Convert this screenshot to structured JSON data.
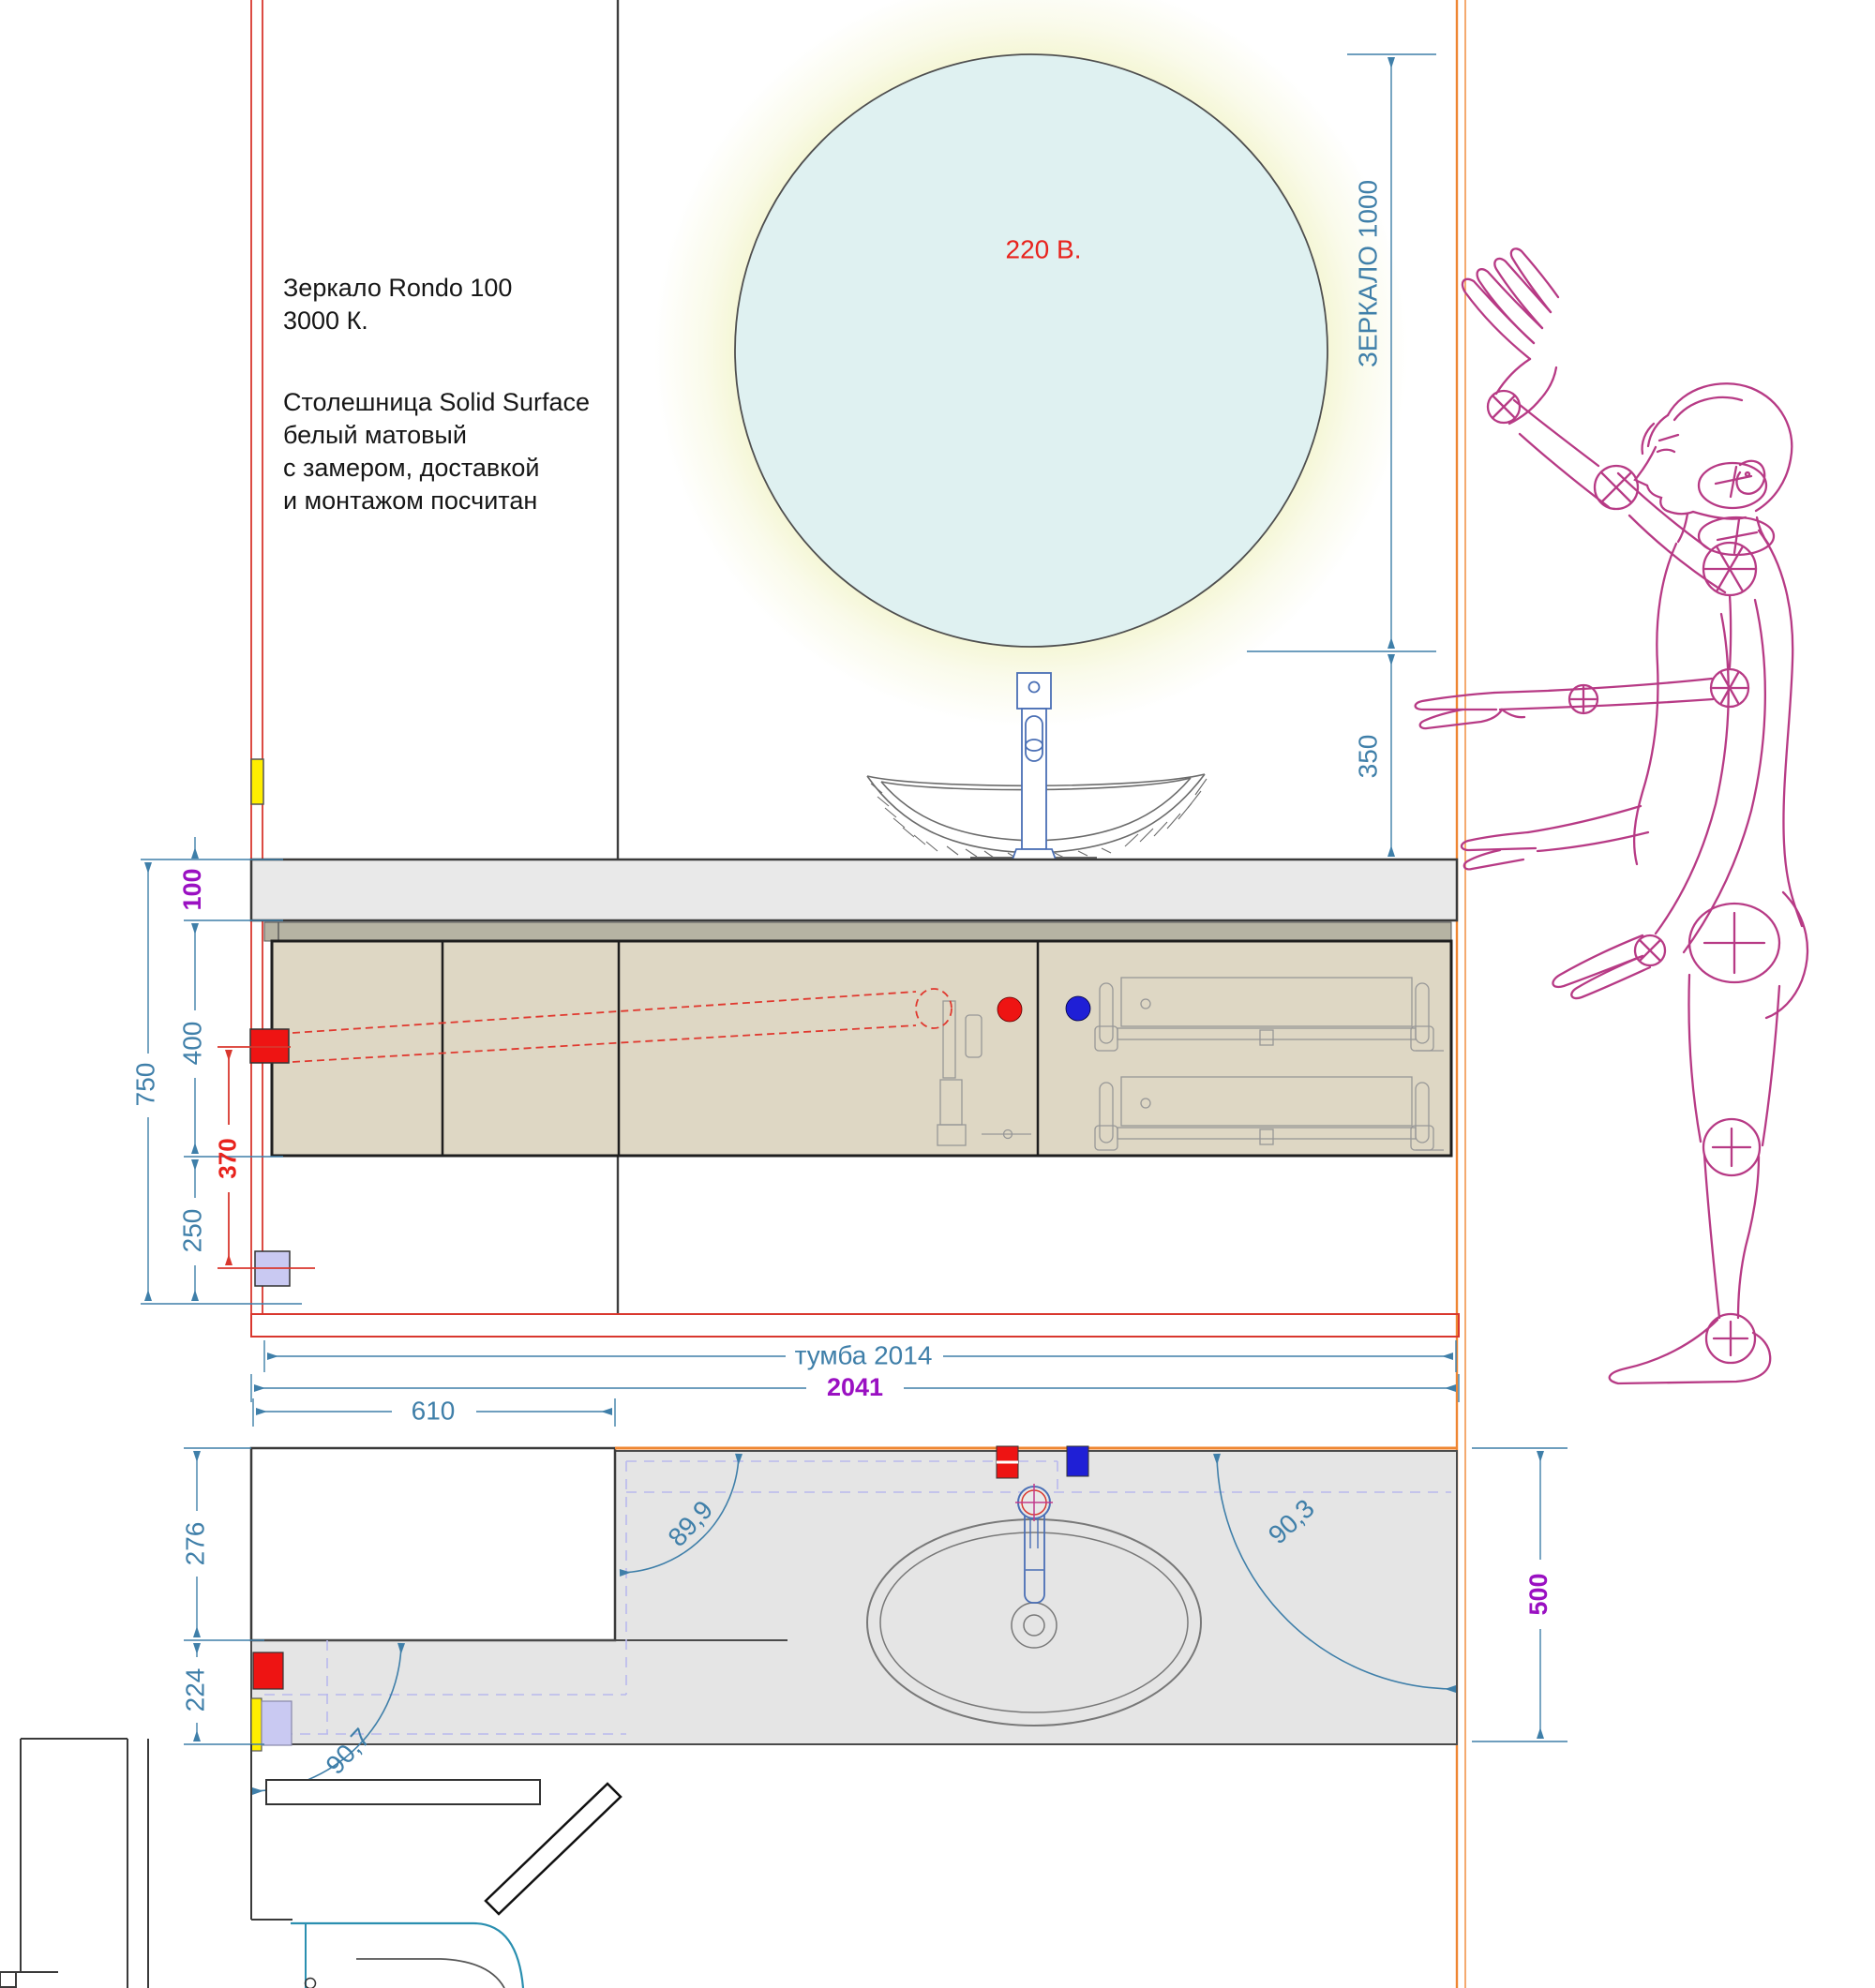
{
  "drawing": {
    "notes": {
      "mirror_spec": "Зеркало Rondo 100\n3000 К.",
      "countertop_spec": "Столешница Solid Surface\nбелый матовый\nс замером, доставкой\nи монтажом посчитан",
      "mirror_power": "220 В."
    },
    "elevation_dims": {
      "mirror_height": "ЗЕРКАЛО 1000",
      "mirror_to_counter": "350",
      "counter_thickness": "100",
      "cabinet_height": "400",
      "socket_span": "370",
      "below_cabinet": "250",
      "total_height": "750",
      "cabinet_width": "тумба 2014"
    },
    "plan_dims": {
      "total_width": "2041",
      "niche_width": "610",
      "niche_depth": "276",
      "front_depth": "224",
      "counter_depth": "500",
      "angle_top_left": "89,9",
      "angle_top_right": "90,3",
      "angle_bottom_left": "90,7"
    },
    "colors": {
      "dimension_blue": "#3f7fa9",
      "dimension_purple": "#9a10c2",
      "accent_red": "#e8231d",
      "wall_orange": "#ef8632",
      "figure_magenta": "#b73a85",
      "cabinet_beige": "#ded7c4",
      "counter_gray": "#e9e9e9",
      "mirror_blue": "#dff1f1",
      "glow_yellow": "#f1f3c6",
      "socket_yellow": "#ffee00",
      "socket_lilac": "#c9c9f2",
      "hot_red": "#ee1413",
      "cold_blue": "#1f1fd6"
    }
  }
}
